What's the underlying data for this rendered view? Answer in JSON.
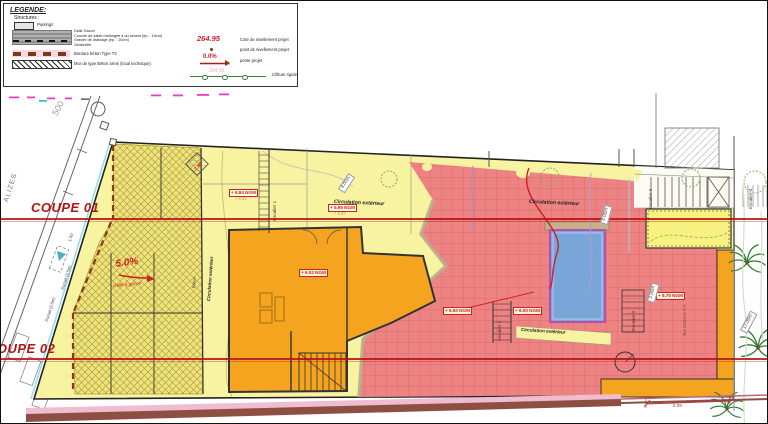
{
  "legend": {
    "title": "LEGENDE:",
    "structures": "Structures :",
    "parkings": "Parkings",
    "layers": [
      "Dalle Gazon",
      "Couche de sable mélangée à du ciment (ép. : 10cm)",
      "Gravier de drainage (ép. : 20cm)",
      "Géotextile"
    ],
    "bordure": "Bordure béton Type T2",
    "mur": "Mur de type Béton armé (local technique)",
    "cote_value": "264.95",
    "cote_label": "Cote de nivellement projet",
    "point_label": "point de nivellement projet",
    "pente_value": "0.0%",
    "pente_label": "pente projet",
    "cloture_ghost": "264.95",
    "cloture_label": "Clôture rigide"
  },
  "plan": {
    "coupe01": "COUPE 01",
    "coupe02": "COUPE 02",
    "slope": "5.0%",
    "dalle_gazon": "Dalle à gazon",
    "parcel": "500",
    "street": "ALIZES",
    "portail_a": "Portail (3.5m)",
    "portail_b": "Portail (3.0m)",
    "dim_150": "1.50",
    "beton": "Béton",
    "circulation": "Circulation extérieur",
    "escalier1": "Escalier 1",
    "escalier2": "Escalier 2",
    "escalier3": "Escalier 3",
    "escalier4": "Escalier 4",
    "gabion": "Mur GABION N°3",
    "levels": [
      {
        "value": "+ 6.84 NGM",
        "sub": "+ 6.82"
      },
      {
        "value": "+ 5.95 NGM",
        "sub": "+ 5.97"
      },
      {
        "value": "+ 6.02 NGM",
        "sub": "+ 6.00"
      },
      {
        "value": "+ 6.50 NGM",
        "sub": ""
      },
      {
        "value": "+ 6.00 NGM",
        "sub": ""
      },
      {
        "value": "+ 6.70 NGM",
        "sub": "+ 6.68"
      }
    ],
    "dims": {
      "a": "4.00m",
      "b": "4.00m",
      "c": "3.00m",
      "d": "12.00m",
      "e": "5.09",
      "f": "7.00"
    }
  }
}
